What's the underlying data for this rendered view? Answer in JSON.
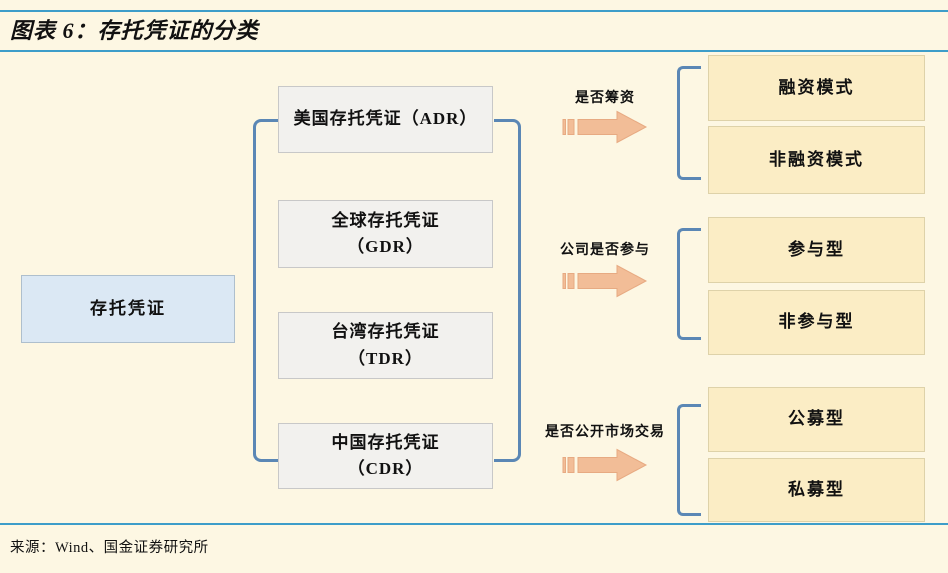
{
  "header": {
    "title": "图表 6：存托凭证的分类"
  },
  "footer": {
    "source": "来源：Wind、国金证券研究所"
  },
  "diagram": {
    "root": {
      "label": "存托凭证"
    },
    "types": [
      {
        "line1": "美国存托凭证（ADR）",
        "line2": ""
      },
      {
        "line1": "全球存托凭证",
        "line2": "（GDR）"
      },
      {
        "line1": "台湾存托凭证",
        "line2": "（TDR）"
      },
      {
        "line1": "中国存托凭证",
        "line2": "（CDR）"
      }
    ],
    "branches": [
      {
        "criterion": "是否筹资",
        "outcomes": [
          "融资模式",
          "非融资模式"
        ]
      },
      {
        "criterion": "公司是否参与",
        "outcomes": [
          "参与型",
          "非参与型"
        ]
      },
      {
        "criterion": "是否公开市场交易",
        "outcomes": [
          "公募型",
          "私募型"
        ]
      }
    ]
  },
  "colors": {
    "page-bg": "#fdf7e3",
    "rule-blue": "#3d9dc9",
    "bracket-blue": "#5b87b5",
    "root-box-bg": "#dbe8f4",
    "root-box-border": "#aebfcd",
    "type-box-bg": "#f2f1ee",
    "type-box-border": "#c8c8c8",
    "outcome-box-bg": "#fbedc5",
    "outcome-box-border": "#ded2a9",
    "arrow-fill": "#f2bd97",
    "arrow-stroke": "#e7aa82",
    "text": "#111111"
  }
}
